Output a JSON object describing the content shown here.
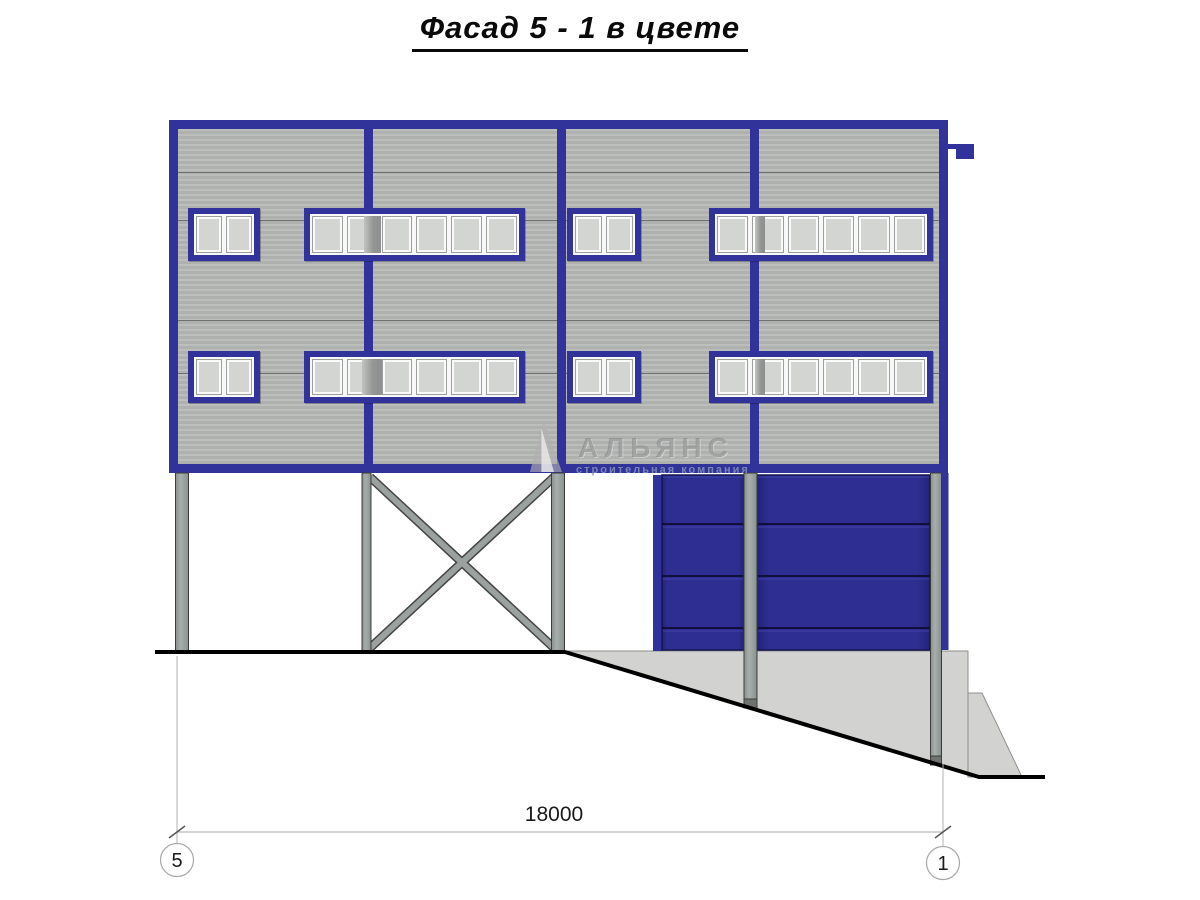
{
  "title": {
    "text": "Фасад 5 - 1 в цвете"
  },
  "watermark": {
    "name": "АЛЬЯНС",
    "tagline": "строительная компания"
  },
  "dimension": {
    "value": "18000"
  },
  "axes": [
    {
      "label": "5"
    },
    {
      "label": "1"
    }
  ],
  "colors": {
    "frame_blue": "#32329b",
    "gate_blue": "#2e2e92",
    "siding_gray": "#afb1af",
    "column_gray": "#9ba19f",
    "concrete_gray": "#d2d2d0",
    "ground_line": "#000000"
  },
  "facade": {
    "x": 169,
    "y": 120,
    "w": 779,
    "h": 353,
    "frame": 9,
    "mullions_x": [
      364,
      557,
      750
    ],
    "joints_y": [
      172,
      220,
      320,
      373
    ],
    "windows": [
      {
        "x": 188,
        "y": 208,
        "w": 72,
        "h": 53,
        "panes": 2
      },
      {
        "x": 304,
        "y": 208,
        "w": 221,
        "h": 53,
        "panes": 6,
        "dark": {
          "x": 54,
          "w": 17
        }
      },
      {
        "x": 567,
        "y": 208,
        "w": 74,
        "h": 53,
        "panes": 6
      },
      {
        "x": 709,
        "y": 208,
        "w": 224,
        "h": 53,
        "panes": 6,
        "dark": {
          "x": 40,
          "w": 10
        }
      },
      {
        "x": 188,
        "y": 351,
        "w": 72,
        "h": 52,
        "panes": 2
      },
      {
        "x": 304,
        "y": 351,
        "w": 221,
        "h": 52,
        "panes": 6,
        "dark": {
          "x": 52,
          "w": 20
        }
      },
      {
        "x": 567,
        "y": 351,
        "w": 74,
        "h": 52,
        "panes": 2
      },
      {
        "x": 709,
        "y": 351,
        "w": 224,
        "h": 52,
        "panes": 6,
        "dark": {
          "x": 40,
          "w": 10
        }
      }
    ],
    "small_window_panes_note": "small windows have 2 panes"
  }
}
